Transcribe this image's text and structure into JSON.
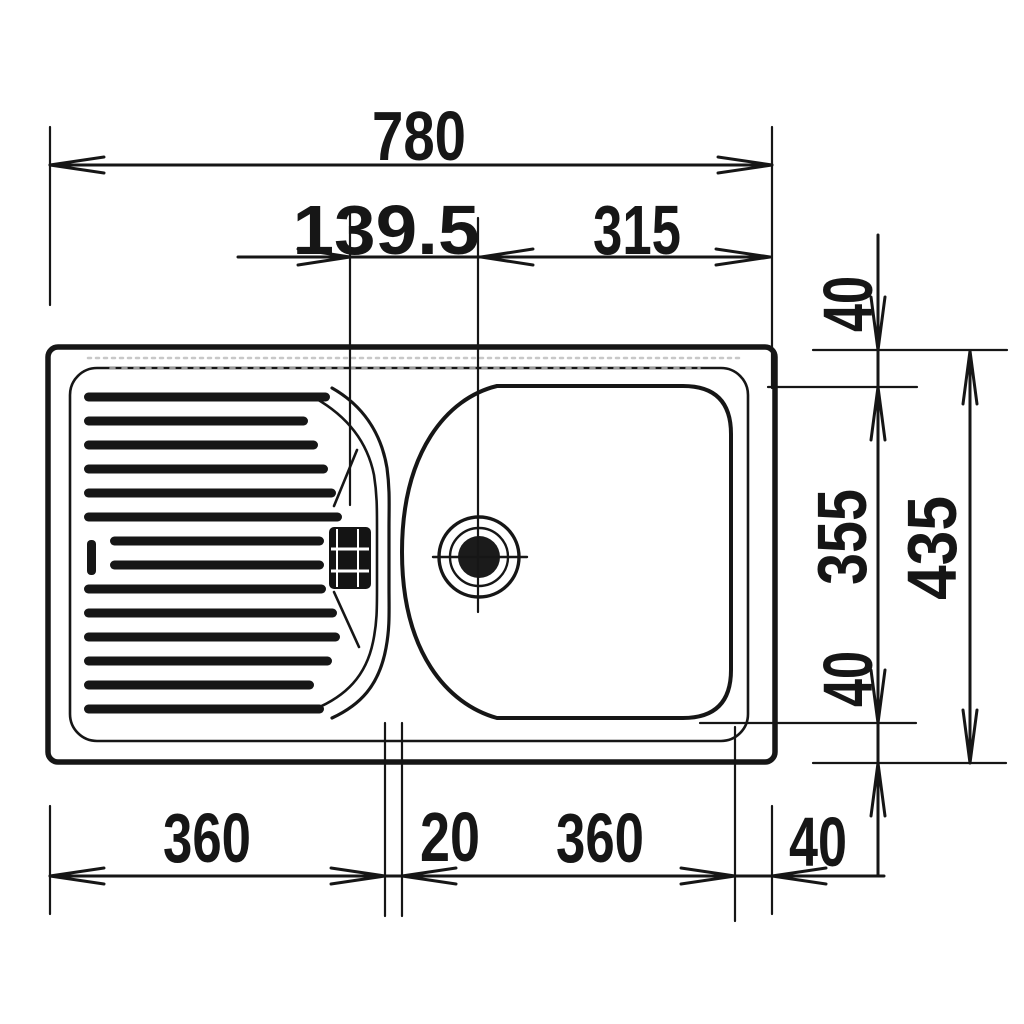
{
  "drawing": {
    "type": "technical dimension drawing",
    "subject": "kitchen sink top view with left drainer and right bowl",
    "units": "mm",
    "colors": {
      "line": "#161616",
      "background": "#ffffff"
    },
    "labels": {
      "overall_width": "780",
      "divider_to_drain": "139.5",
      "drain_to_right_edge": "315",
      "top_margin": "40",
      "bowl_depth": "355",
      "bottom_margin": "40",
      "overall_depth": "435",
      "drainer_width": "360",
      "center_gap": "20",
      "bowl_width": "360",
      "right_margin": "40"
    }
  }
}
